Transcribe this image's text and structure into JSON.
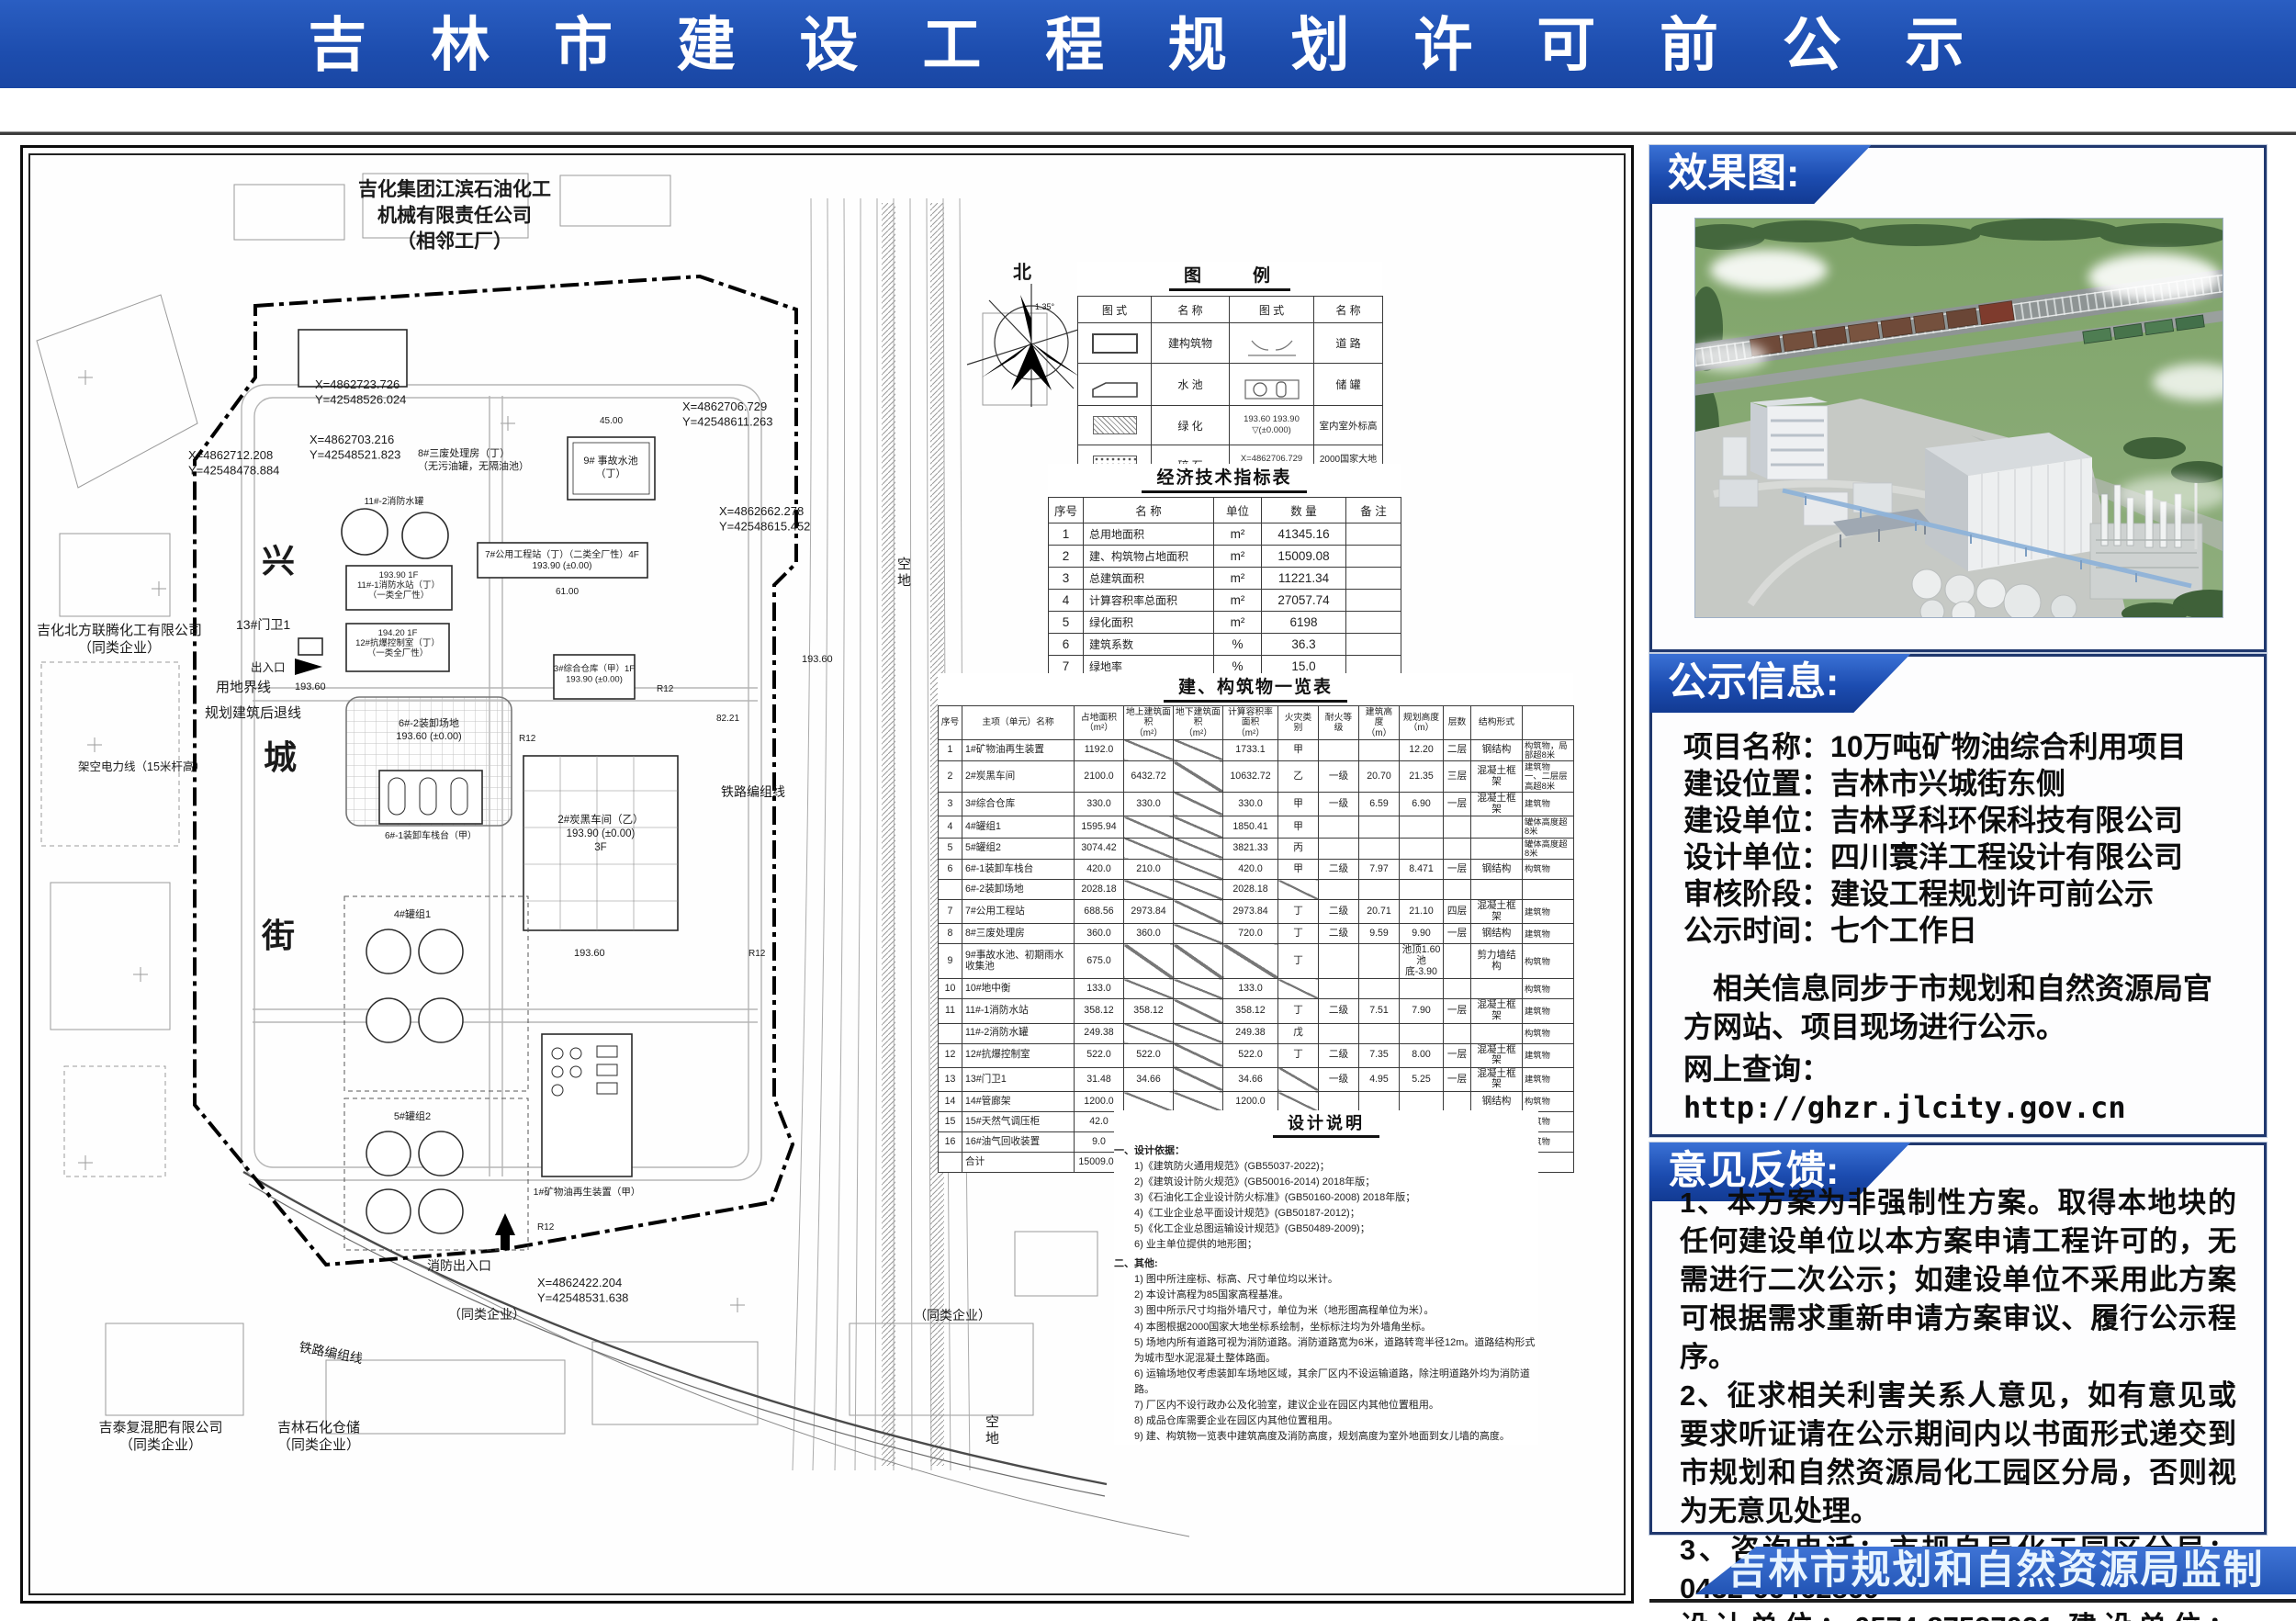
{
  "banner": {
    "title": "吉 林 市 建 设 工 程 规 划 许 可 前 公 示"
  },
  "map": {
    "labels": {
      "neighbor_top": "吉化集团江滨石油化工\n机械有限责任公司\n（相邻工厂）",
      "street_1": "兴",
      "street_2": "城",
      "street_3": "街",
      "boundary": "用地界线",
      "setback": "规划建筑后退线",
      "power_line": "架空电力线（15米杆高）",
      "gate": "13#门卫1",
      "entrance": "出入口",
      "fire_exit": "消防出入口",
      "company_left": "吉化北方联腾化工有限公司\n（同类企业）",
      "company_jitai": "吉泰复混肥有限公司\n（同类企业）",
      "company_storage": "吉林石化仓储\n（同类企业）",
      "similar_1": "（同类企业）",
      "similar_2": "（同类企业）",
      "railway_1": "铁路编组线",
      "railway_2": "铁路编组线",
      "vacant_1": "空\n地",
      "vacant_2": "空\n地",
      "north": "北",
      "north_angle": "1.35°",
      "b1": "1#矿物油再生装置（甲）",
      "b2": "2#炭黑车间（乙）\n193.90 (±0.00)\n3F",
      "b3": "3#综合仓库（甲）1F\n193.90 (±0.00)",
      "g4": "4#罐组1",
      "g5": "5#罐组2",
      "b61": "6#-1装卸车栈台（甲）",
      "b62": "6#-2装卸场地\n193.60 (±0.00)",
      "b7": "7#公用工程站（丁）（二类全厂性）4F\n193.90 (±0.00)",
      "b8": "8#三废处理房（丁）\n（无污油罐，无隔油池）",
      "b9": "9# 事故水池\n（丁）",
      "b11t": "11#-2消防水罐",
      "b11": "193.90  1F\n11#-1消防水站（丁）\n（一类全厂性）",
      "b12": "194.20  1F\n12#抗爆控制室（丁）\n（一类全厂性）",
      "c1": "X=4862723.726\nY=42548526.024",
      "c2": "X=4862703.216\nY=42548521.823",
      "c3": "X=4862712.208\nY=42548478.884",
      "c4": "X=4862706.729\nY=42548611.263",
      "c5": "X=4862662.278\nY=42548615.452",
      "c6": "X=4862422.204\nY=42548531.638",
      "dim_1": "45.00",
      "dim_2": "61.00",
      "dim_3": "82.21",
      "r12": "R12",
      "elev_1": "193.60"
    },
    "legend": {
      "title": "图　　例",
      "head": [
        "图  式",
        "名  称",
        "图  式",
        "名  称"
      ],
      "names": [
        "建构筑物",
        "道    路",
        "水    池",
        "储    罐",
        "绿    化",
        "室内室外标高",
        "碎    石",
        "2000国家大地坐标"
      ],
      "elev_text": "193.60   193.90\n▽(±0.000)",
      "coord_text": "X=4862706.729\nY=42548611.263"
    },
    "econ": {
      "title": "经济技术指标表",
      "head": [
        "序号",
        "名        称",
        "单位",
        "数    量",
        "备  注"
      ],
      "rows": [
        [
          "1",
          "总用地面积",
          "m²",
          "41345.16",
          ""
        ],
        [
          "2",
          "建、构筑物占地面积",
          "m²",
          "15009.08",
          ""
        ],
        [
          "3",
          "总建筑面积",
          "m²",
          "11221.34",
          ""
        ],
        [
          "4",
          "计算容积率总面积",
          "m²",
          "27057.74",
          ""
        ],
        [
          "5",
          "绿化面积",
          "m²",
          "6198",
          ""
        ],
        [
          "6",
          "建筑系数",
          "%",
          "36.3",
          ""
        ],
        [
          "7",
          "绿地率",
          "%",
          "15.0",
          ""
        ],
        [
          "8",
          "容积率",
          "",
          "0.65",
          ""
        ]
      ]
    },
    "bldg": {
      "title": "建、构筑物一览表",
      "head": [
        "序号",
        "主项（单元）名称",
        "占地面积\n（m²）",
        "地上建筑面积\n（m²）",
        "地下建筑面积\n（m²）",
        "计算容积率面积\n（m²）",
        "火灾类别",
        "耐火等级",
        "建筑高度\n（m）",
        "规划高度\n（m）",
        "层数",
        "结构形式",
        ""
      ],
      "rows": [
        [
          "1",
          "1#矿物油再生装置",
          "1192.0",
          "/",
          "/",
          "1733.1",
          "甲",
          "",
          "",
          "12.20",
          "二层",
          "钢结构",
          "构筑物，局部超8米"
        ],
        [
          "2",
          "2#炭黑车间",
          "2100.0",
          "6432.72",
          "/",
          "10632.72",
          "乙",
          "一级",
          "20.70",
          "21.35",
          "三层",
          "混凝土框架",
          "建筑物\n一、二层层高超8米"
        ],
        [
          "3",
          "3#综合仓库",
          "330.0",
          "330.0",
          "/",
          "330.0",
          "甲",
          "一级",
          "6.59",
          "6.90",
          "一层",
          "混凝土框架",
          "建筑物"
        ],
        [
          "4",
          "4#罐组1",
          "1595.94",
          "/",
          "/",
          "1850.41",
          "甲",
          "",
          "",
          "",
          "",
          "",
          "罐体高度超8米"
        ],
        [
          "5",
          "5#罐组2",
          "3074.42",
          "/",
          "/",
          "3821.33",
          "丙",
          "",
          "",
          "",
          "",
          "",
          "罐体高度超8米"
        ],
        [
          "6",
          "6#-1装卸车栈台",
          "420.0",
          "210.0",
          "/",
          "420.0",
          "甲",
          "二级",
          "7.97",
          "8.471",
          "一层",
          "钢结构",
          "构筑物"
        ],
        [
          "",
          "6#-2装卸场地",
          "2028.18",
          "/",
          "/",
          "2028.18",
          "/",
          "",
          "",
          "",
          "",
          "",
          ""
        ],
        [
          "7",
          "7#公用工程站",
          "688.56",
          "2973.84",
          "/",
          "2973.84",
          "丁",
          "二级",
          "20.71",
          "21.10",
          "四层",
          "混凝土框架",
          "建筑物"
        ],
        [
          "8",
          "8#三废处理房",
          "360.0",
          "360.0",
          "/",
          "720.0",
          "丁",
          "二级",
          "9.59",
          "9.90",
          "一层",
          "钢结构",
          "建筑物"
        ],
        [
          "9",
          "9#事故水池、初期雨水收集池",
          "675.0",
          "/",
          "/",
          "/",
          "丁",
          "",
          "",
          "池顶1.60\n池底-3.90",
          "",
          "剪力墙结构",
          "构筑物"
        ],
        [
          "10",
          "10#地中衡",
          "133.0",
          "/",
          "/",
          "133.0",
          "/",
          "",
          "",
          "",
          "",
          "",
          "构筑物"
        ],
        [
          "11",
          "11#-1消防水站",
          "358.12",
          "358.12",
          "/",
          "358.12",
          "丁",
          "二级",
          "7.51",
          "7.90",
          "一层",
          "混凝土框架",
          "建筑物"
        ],
        [
          "",
          "11#-2消防水罐",
          "249.38",
          "/",
          "/",
          "249.38",
          "戊",
          "",
          "",
          "",
          "",
          "",
          "构筑物"
        ],
        [
          "12",
          "12#抗爆控制室",
          "522.0",
          "522.0",
          "/",
          "522.0",
          "丁",
          "二级",
          "7.35",
          "8.00",
          "一层",
          "混凝土框架",
          "建筑物"
        ],
        [
          "13",
          "13#门卫1",
          "31.48",
          "34.66",
          "/",
          "34.66",
          "/",
          "一级",
          "4.95",
          "5.25",
          "一层",
          "混凝土框架",
          "建筑物"
        ],
        [
          "14",
          "14#管廊架",
          "1200.0",
          "/",
          "/",
          "1200.0",
          "/",
          "",
          "",
          "",
          "",
          "钢结构",
          "构筑物"
        ],
        [
          "15",
          "15#天然气调压柜",
          "42.0",
          "/",
          "/",
          "42.0",
          "/",
          "",
          "",
          "",
          "",
          "",
          "构筑物"
        ],
        [
          "16",
          "16#油气回收装置",
          "9.0",
          "/",
          "/",
          "9.0",
          "甲",
          "",
          "",
          "",
          "",
          "",
          "构筑物"
        ],
        [
          "",
          "合计",
          "15009.08",
          "11221.34",
          "/",
          "27057.74",
          "",
          "",
          "",
          "",
          "",
          "",
          ""
        ]
      ]
    },
    "notes": {
      "title": "设计说明",
      "h1": "一、设计依据：",
      "g1": [
        "1)《建筑防火通用规范》(GB55037-2022)；",
        "2)《建筑设计防火规范》(GB50016-2014) 2018年版；",
        "3)《石油化工企业设计防火标准》(GB50160-2008) 2018年版；",
        "4)《工业企业总平面设计规范》(GB50187-2012)；",
        "5)《化工企业总图运输设计规范》(GB50489-2009)；",
        "6) 业主单位提供的地形图；"
      ],
      "h2": "二、其他:",
      "g2": [
        "1) 图中所注座标、标高、尺寸单位均以米计。",
        "2) 本设计高程为85国家高程基准。",
        "3) 图中所示尺寸均指外墙尺寸，单位为米（地形图高程单位为米）。",
        "4) 本图根据2000国家大地坐标系绘制，坐标标注均为外墙角坐标。",
        "5) 场地内所有道路可视为消防道路。消防道路宽为6米，道路转弯半径12m。道路结构形式为城市型水泥混凝土整体路面。",
        "6) 运输场地仅考虑装卸车场地区域，其余厂区内不设运输道路，除注明道路外均为消防道路。",
        "7) 厂区内不设行政办公及化验室，建议企业在园区内其他位置租用。",
        "8) 成品仓库需要企业在园区内其他位置租用。",
        "9) 建、构筑物一览表中建筑高度及消防高度，规划高度为室外地面到女儿墙的高度。"
      ]
    }
  },
  "sidebar": {
    "render": {
      "badge": "效果图:"
    },
    "info": {
      "badge": "公示信息:",
      "fields": [
        {
          "label": "项目名称：",
          "value": "10万吨矿物油综合利用项目"
        },
        {
          "label": "建设位置：",
          "value": "吉林市兴城街东侧"
        },
        {
          "label": "建设单位：",
          "value": "吉林孚科环保科技有限公司"
        },
        {
          "label": "设计单位：",
          "value": "四川寰洋工程设计有限公司"
        },
        {
          "label": "审核阶段：",
          "value": "建设工程规划许可前公示"
        },
        {
          "label": "公示时间：",
          "value": "七个工作日"
        }
      ],
      "note": "相关信息同步于市规划和自然资源局官方网站、项目现场进行公示。",
      "url_label": "网上查询：",
      "url": "http://ghzr.jlcity.gov.cn"
    },
    "feedback": {
      "badge": "意见反馈:",
      "items": [
        "1、本方案为非强制性方案。取得本地块的任何建设单位以本方案申请工程许可的，无需进行二次公示；如建设单位不采用此方案可根据需求重新申请方案审议、履行公示程序。",
        "2、征求相关利害关系人意见，如有意见或要求听证请在公示期间内以书面形式递交到市规划和自然资源局化工园区分局，否则视为无意见处理。",
        "3、咨询电话：市规自局化工园区分局：0432-66462869",
        "设计单位：0574-87527021  建设单位：15843281990"
      ]
    },
    "footer": "吉林市规划和自然资源局监制"
  }
}
